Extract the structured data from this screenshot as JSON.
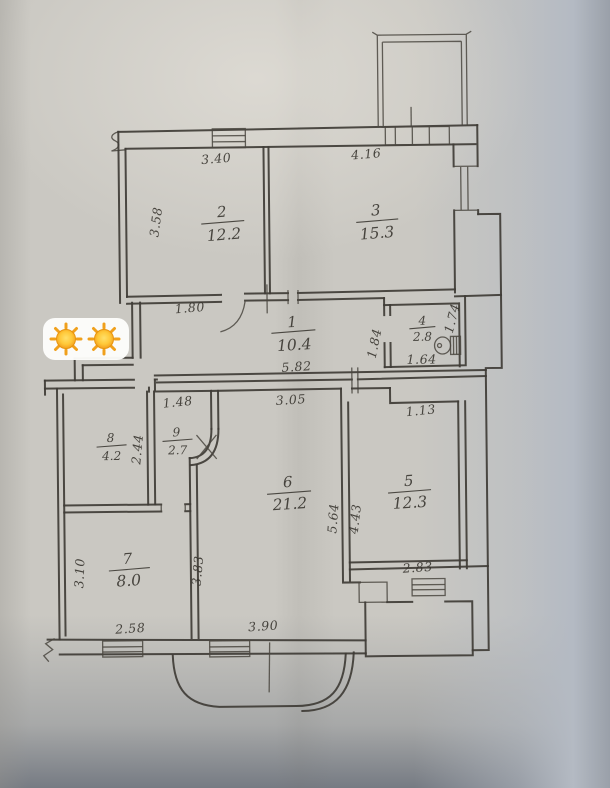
{
  "document": {
    "kind": "hand-drawn apartment floor plan photo"
  },
  "rooms": {
    "room1": {
      "number": "1",
      "area": "10.4"
    },
    "room2": {
      "number": "2",
      "area": "12.2"
    },
    "room3": {
      "number": "3",
      "area": "15.3"
    },
    "room4": {
      "number": "4",
      "area": "2.8"
    },
    "room5": {
      "number": "5",
      "area": "12.3"
    },
    "room6": {
      "number": "6",
      "area": "21.2"
    },
    "room7": {
      "number": "7",
      "area": "8.0"
    },
    "room8": {
      "number": "8",
      "area": "4.2"
    },
    "room9": {
      "number": "9",
      "area": "2.7"
    }
  },
  "dims": {
    "room2_width": "3.40",
    "room2_depth": "3.58",
    "room3_width": "4.16",
    "hall_left": "1.80",
    "hall_width": "5.82",
    "wc_depth": "1.84",
    "wc_right": "1.74",
    "wc_width": "1.64",
    "room9_width": "1.48",
    "room8_depth": "2.44",
    "room6_width_top": "3.05",
    "room5_notch": "1.13",
    "room6_right": "5.64",
    "room5_left": "4.43",
    "room7_left": "3.10",
    "room7_right": "3.83",
    "room7_width": "2.58",
    "room6_width_bottom": "3.90",
    "room5_width_bottom": "2.83"
  },
  "colors": {
    "paper": "#cac8c2",
    "ink": "#3f3c36",
    "sun_core": "#ffd23e",
    "sun_edge": "#f0971a",
    "sticker_bg": "#fdfdfb"
  },
  "overlay": {
    "sun_emoji_count": 2
  }
}
